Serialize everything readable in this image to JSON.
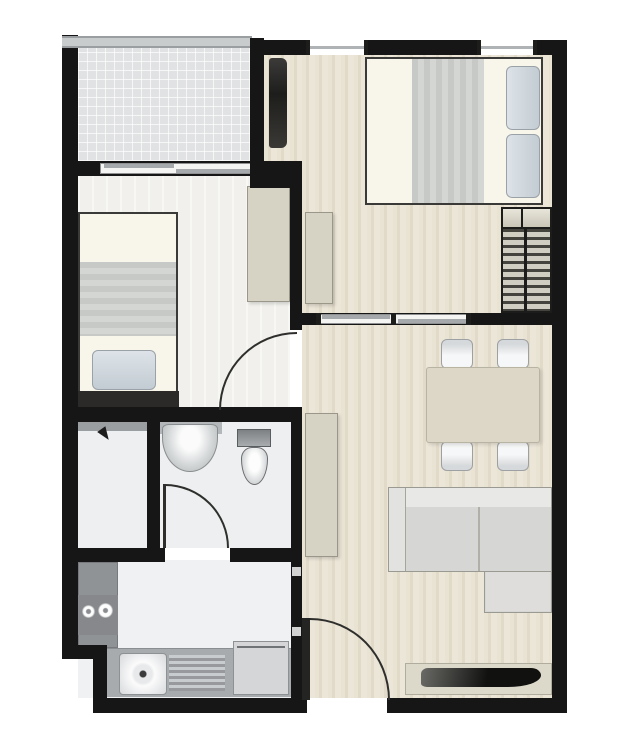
{
  "meta": {
    "type": "architectural-floor-plan",
    "view": "top-down",
    "visible_text": [],
    "description": "One-bedroom-plus apartment floor plan: balcony top-left, master bedroom top-right, second bedroom mid-left, bathroom and shower center-left, kitchen bottom-left, combined living-dining room on the right with entrance door at bottom"
  },
  "colors": {
    "wall": "#161616",
    "railing": "#c9cccd",
    "balcony": "#e0e2e4",
    "woodA": "#e9e3d4",
    "woodB": "#e1dac9",
    "woodC": "#ece6d8",
    "pale": "#f1f0ec",
    "bath": "#edeff0",
    "kitchen": "#f0f1f2",
    "counterDark": "#909396",
    "counterMid": "#a8abad",
    "cabinet": "#d6d2c4",
    "cabinetBorder": "#9a968a",
    "sheet": "#f8f5ea",
    "pillowB": "#9aa2a8",
    "darkFurniture": "#2b2a28",
    "sofa": "#d6d6d4",
    "sofaBack": "#e8e8e6",
    "sofaBorder": "#9a9a92",
    "table": "#dcd7c6",
    "stripeD": "#44433e",
    "stripeL": "#d0cdc3",
    "fixture": "#9fa2a4"
  },
  "rooms": [
    {
      "id": "balcony",
      "features": [
        "tiled-floor",
        "railing",
        "sliding-glass-door"
      ]
    },
    {
      "id": "bedroom-1",
      "features": [
        "double-bed",
        "two-pillows",
        "wall-tv",
        "hanging-wardrobe",
        "dresser",
        "two-windows",
        "sliding-door"
      ]
    },
    {
      "id": "bedroom-2",
      "features": [
        "single-bed",
        "pillow",
        "footboard-console",
        "wardrobe",
        "swing-door"
      ]
    },
    {
      "id": "bathroom",
      "features": [
        "wash-basin",
        "toilet",
        "swing-door"
      ]
    },
    {
      "id": "shower-area",
      "features": [
        "shower-head",
        "shelf"
      ]
    },
    {
      "id": "kitchen",
      "features": [
        "cooktop-two-burners",
        "sink",
        "drainboard",
        "refrigerator",
        "l-counter"
      ]
    },
    {
      "id": "living-dining",
      "features": [
        "dining-table",
        "four-chairs",
        "l-shaped-sofa",
        "tv-console",
        "tv",
        "console-cabinet",
        "entrance-swing-door"
      ]
    }
  ]
}
